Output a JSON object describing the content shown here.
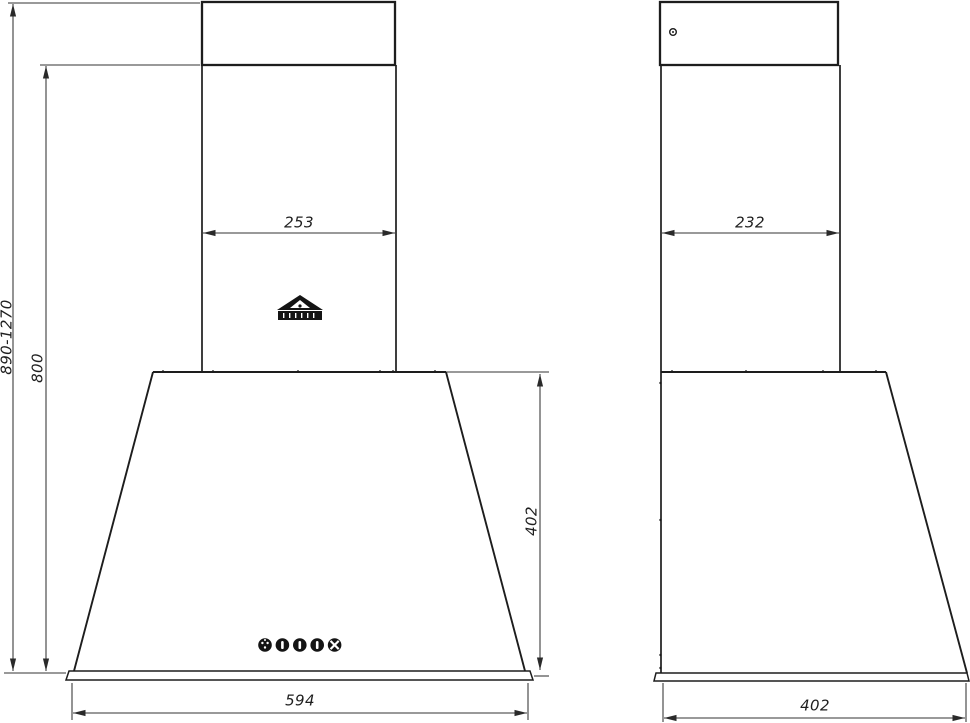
{
  "canvas": {
    "background": "#ffffff",
    "line_color": "#1d1d1d",
    "dim_line_color": "#333333",
    "text_color": "#1f1f1f"
  },
  "front_view": {
    "dim_total_height_range": "890-1270",
    "dim_height_to_chimney_joint": "800",
    "dim_chimney_width": "253",
    "dim_canopy_height": "402",
    "dim_canopy_width": "594",
    "logo_icon": "brand-logo",
    "control_buttons": [
      "light-button",
      "speed-1-button",
      "speed-2-button",
      "speed-3-button",
      "fan-button"
    ]
  },
  "side_view": {
    "dim_chimney_depth": "232",
    "dim_canopy_depth": "402",
    "screw_hole_icon": "screw-hole"
  }
}
